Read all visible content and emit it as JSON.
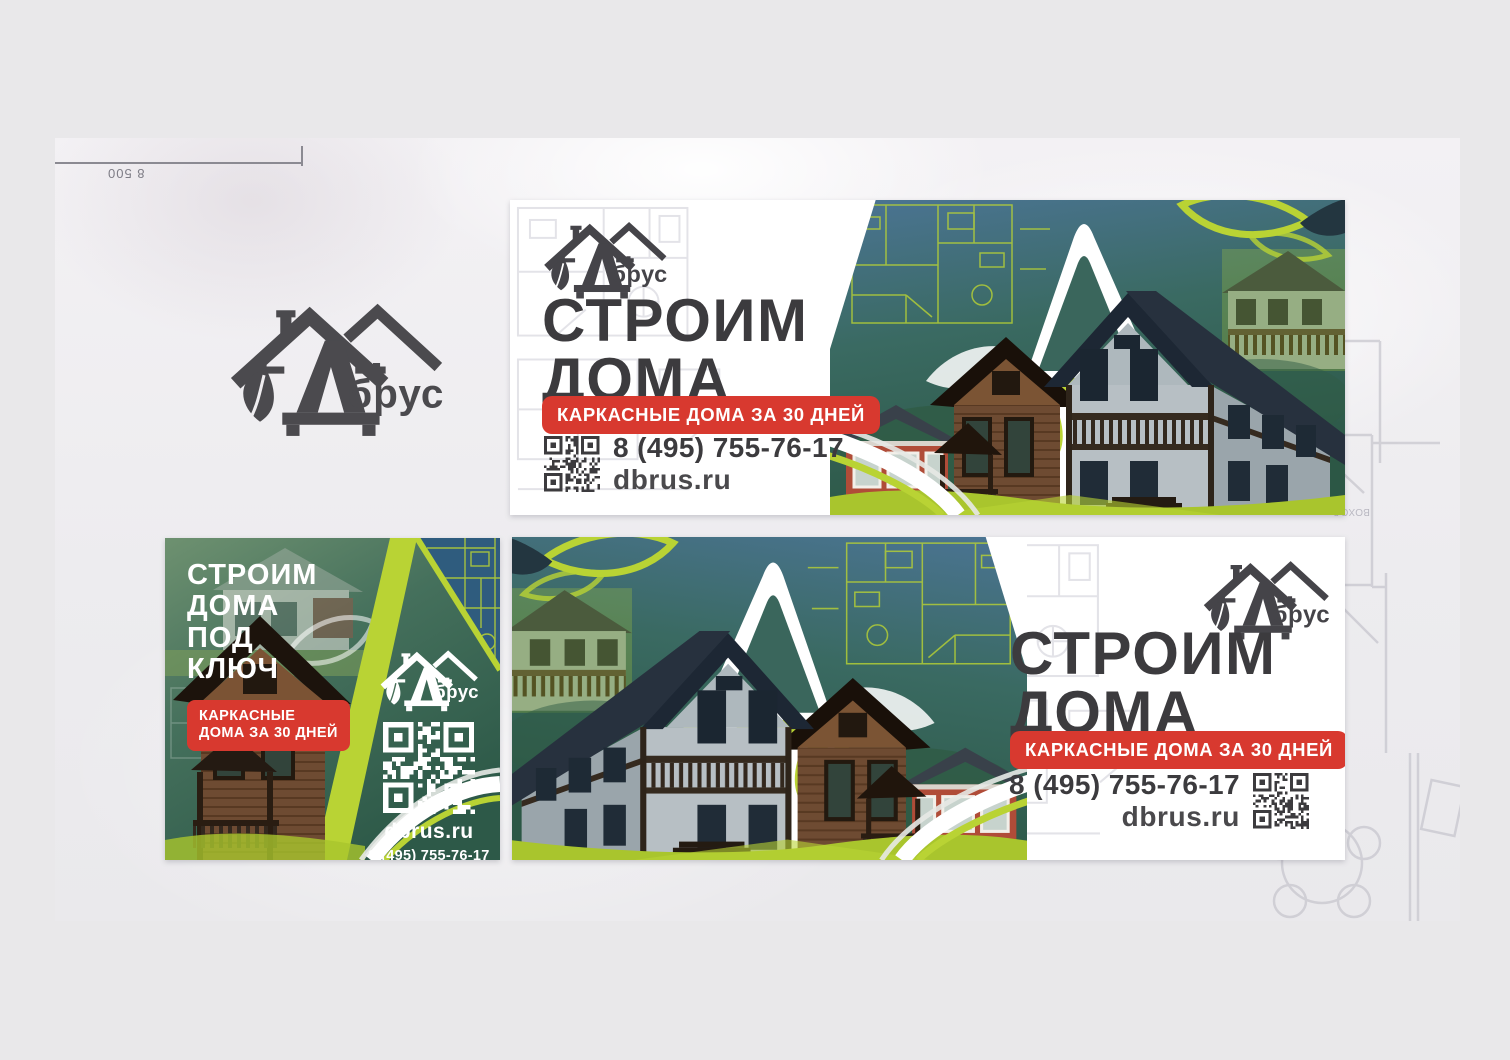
{
  "meta": {
    "dimension_label": "8 500",
    "plan_labels": [
      "4,24",
      "Тамб",
      "ВОХОД"
    ]
  },
  "brand": {
    "logo_text": "брус"
  },
  "colors": {
    "lime": "#b9d334",
    "red": "#d8392f",
    "headline_dark": "#3c3b3e",
    "logo_gray": "#4b4a4e",
    "teal_top": "#4b7494",
    "teal_bottom": "#2c5745"
  },
  "banners": {
    "wide_top": {
      "headline": [
        "СТРОИМ",
        "ДОМА"
      ],
      "badge": "КАРКАСНЫЕ ДОМА ЗА 30 ДНЕЙ",
      "phone": "8 (495) 755-76-17",
      "site": "dbrus.ru"
    },
    "square": {
      "headline": [
        "СТРОИМ",
        "ДОМА",
        "ПОД",
        "КЛЮЧ"
      ],
      "badge": [
        "КАРКАСНЫЕ",
        "ДОМА ЗА 30 ДНЕЙ"
      ],
      "site": "dbrus.ru",
      "phone": "8 (495) 755-76-17"
    },
    "wide_bottom": {
      "headline": [
        "СТРОИМ",
        "ДОМА"
      ],
      "badge": "КАРКАСНЫЕ ДОМА ЗА 30 ДНЕЙ",
      "phone": "8 (495) 755-76-17",
      "site": "dbrus.ru"
    }
  }
}
